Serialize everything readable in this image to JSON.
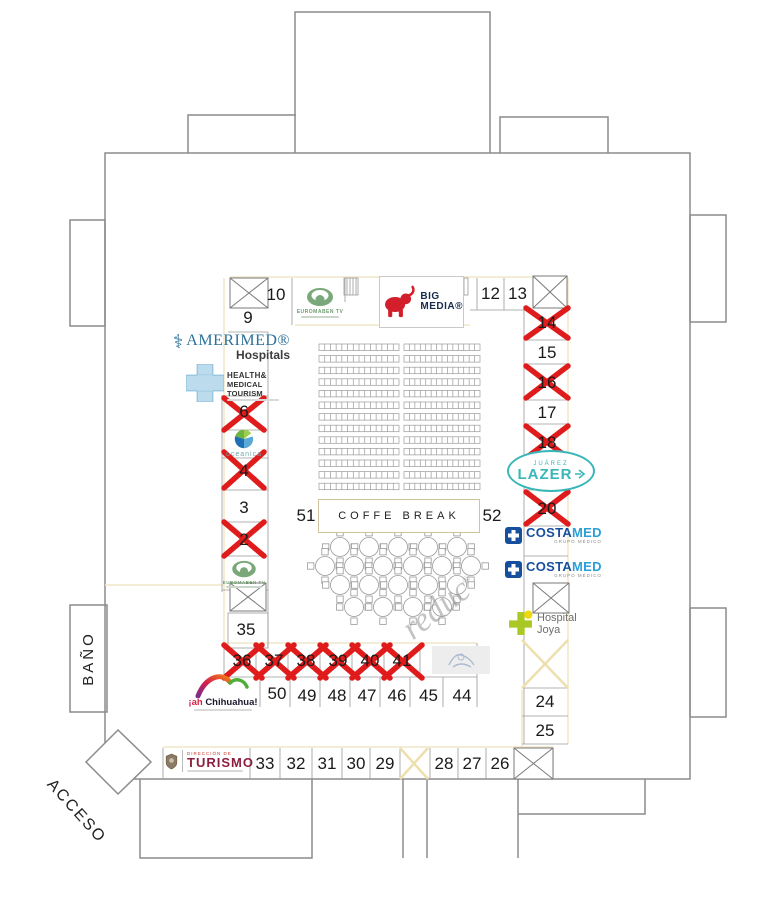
{
  "labels": {
    "bano": "BAÑO",
    "acceso": "ACCESO",
    "coffe_break": "COFFE BREAK"
  },
  "watermark": {
    "text": "reduc",
    "reg": "®"
  },
  "booths": {
    "n2": "2",
    "n3": "3",
    "n4": "4",
    "n6": "6",
    "n9": "9",
    "n10": "10",
    "n12": "12",
    "n13": "13",
    "n14": "14",
    "n15": "15",
    "n16": "16",
    "n17": "17",
    "n18": "18",
    "n20": "20",
    "n24": "24",
    "n25": "25",
    "n26": "26",
    "n27": "27",
    "n28": "28",
    "n29": "29",
    "n30": "30",
    "n31": "31",
    "n32": "32",
    "n33": "33",
    "n35": "35",
    "n36": "36",
    "n37": "37",
    "n38": "38",
    "n39": "39",
    "n40": "40",
    "n41": "41",
    "n44": "44",
    "n45": "45",
    "n46": "46",
    "n47": "47",
    "n48": "48",
    "n49": "49",
    "n50": "50",
    "n51": "51",
    "n52": "52"
  },
  "logos": {
    "euromaben": {
      "name": "EUROMABEN TV"
    },
    "big_media": {
      "line1": "BIG",
      "line2": "MEDIA®"
    },
    "amerimed": {
      "name": "AMERIMED®",
      "sub": "Hospitals"
    },
    "health_medical": {
      "line1": "HEALTH&",
      "line2": "MEDICAL TOURISM"
    },
    "oceanica": {
      "name": "oceanica"
    },
    "lazer": {
      "top": "JUÁREZ",
      "main": "LAZER"
    },
    "costamed": {
      "part1": "COSTA",
      "part2": "MED",
      "sub": "GRUPO MÉDICO"
    },
    "hospital_joya": {
      "line1": "Hospital",
      "line2": "Joya"
    },
    "chihuahua": {
      "prefix": "¡ah",
      "name": "Chihuahua!"
    },
    "turismo": {
      "pre": "DIRECCIÓN DE",
      "main": "TURISMO"
    }
  },
  "colors": {
    "wall": "#8c8c8c",
    "cream_line": "#f1e7c8",
    "cancel_red": "#e01b1b",
    "yellow_x": "#eedfae",
    "costamed_blue": "#164f9e",
    "costamed_light": "#2a9fd8",
    "lazer_teal": "#39b6b8",
    "amerimed_teal": "#2b7199",
    "euromaben_green": "#7aa87a",
    "joya_green": "#a9c824",
    "joya_yellow": "#f0d60e",
    "turismo_maroon": "#8c1f3f",
    "bigmedia_red": "#d31f2b",
    "bigmedia_navy": "#172b4d"
  },
  "seating": {
    "row_blocks": 2,
    "rows_per_block": 13,
    "seats_per_row": 14,
    "round_tables": 20,
    "chairs_per_table": 4
  }
}
